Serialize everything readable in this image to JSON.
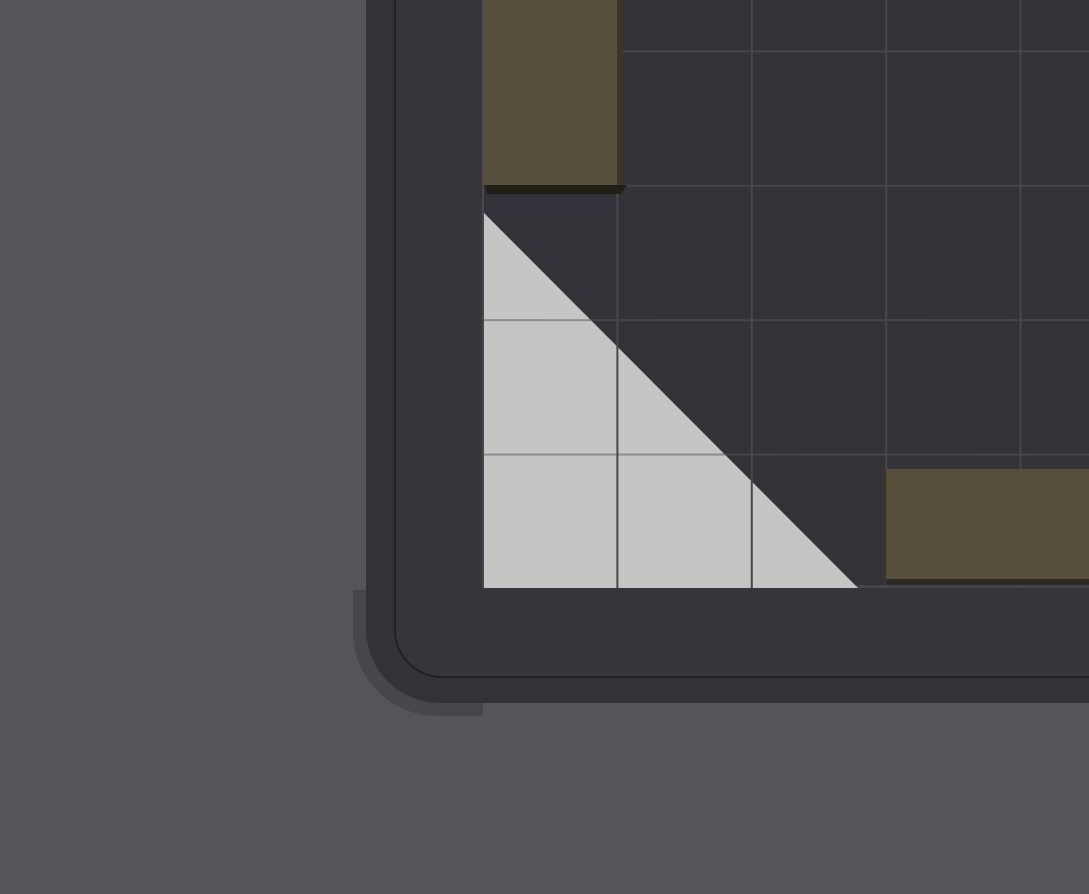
{
  "scene": {
    "description": "Zoomed corner of a dark puzzle-game board: rounded dark shell with inset outline, square grid playfield, two olive rectangular block pieces with dark bevels and drop shadows, and a light gray right-triangle piece lying under the grid lines in the bottom-left corner of the field",
    "colors": {
      "page_bg": "#55545A",
      "corner_shadow": "#46464B",
      "board_shell": "#333238",
      "board_face": "#36353B",
      "board_outline": "#202025",
      "play_bg": "#333238",
      "grid_line_vertical": "#47474C",
      "grid_line_horizontal": "rgba(85,86,90,0.52)",
      "triangle_fill": "#C5C6C4",
      "piece_olive": "#564F3B",
      "piece_olive_bevel": "#3B3524",
      "piece_shadow_dark": "#211E15",
      "piece_shadow_soft": "#2B2A24"
    },
    "grid": {
      "cell_size_px": 134.4,
      "visible_columns": 5,
      "visible_rows": 5,
      "lines_over_triangle": true,
      "lines_over_blocks": false
    },
    "pieces": [
      {
        "name": "vertical-olive-block",
        "shape": "rectangle",
        "grid_size": "1x2",
        "color": "#564F3B",
        "position": "top-left of visible field, bottom edge on second horizontal grid line, extends above screen top",
        "bevel_side": "right",
        "shadow_side": "bottom"
      },
      {
        "name": "light-triangle",
        "shape": "right-triangle",
        "legs_cells": 2.8,
        "color": "#C5C6C4",
        "position": "bottom-left corner of field, right angle at bottom-left, hypotenuse rising to the left",
        "rendered_below_grid_lines": true
      },
      {
        "name": "horizontal-olive-block",
        "shape": "rectangle",
        "grid_size": "2x1",
        "color": "#564F3B",
        "position": "bottom-right of visible field, extends past right screen edge",
        "bevel_side": "left",
        "shadow_side": "bottom"
      }
    ]
  }
}
